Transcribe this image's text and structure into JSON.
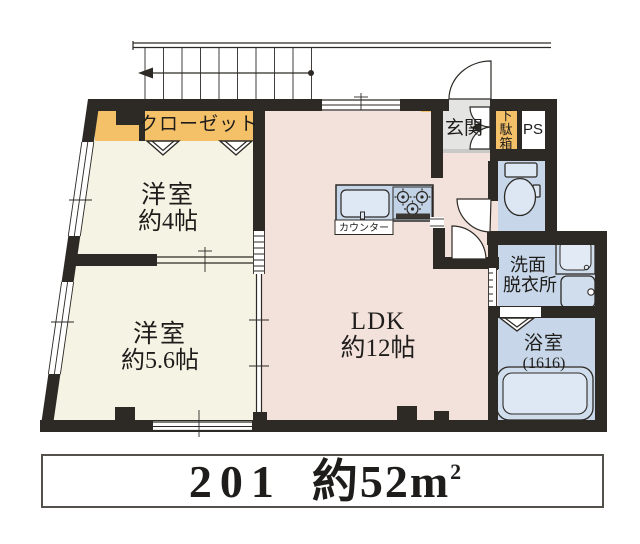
{
  "plan": {
    "closet_label": "クローゼット",
    "bedroom1_name": "洋室",
    "bedroom1_size": "約4帖",
    "bedroom2_name": "洋室",
    "bedroom2_size": "約5.6帖",
    "ldk_name": "LDK",
    "ldk_size": "約12帖",
    "entrance_label": "玄関",
    "shoe_box_chars": [
      "下",
      "駄",
      "箱"
    ],
    "ps_label": "PS",
    "washroom_line1": "洗面",
    "washroom_line2": "脱衣所",
    "bathroom_name": "浴室",
    "bathroom_size": "(1616)",
    "counter_label": "カウンター"
  },
  "caption": {
    "unit_number": "201",
    "area_text": "約52m",
    "area_sup": "2"
  },
  "colors": {
    "wall": "#2d2a26",
    "bedroom_floor": "#f5f3e4",
    "ldk_floor": "#f3e2dc",
    "accent_orange": "#f4c169",
    "wet_area_blue": "#c7d7e9",
    "fixture_blue": "#dce7f3",
    "entrance_gray": "#e4e4e3"
  }
}
